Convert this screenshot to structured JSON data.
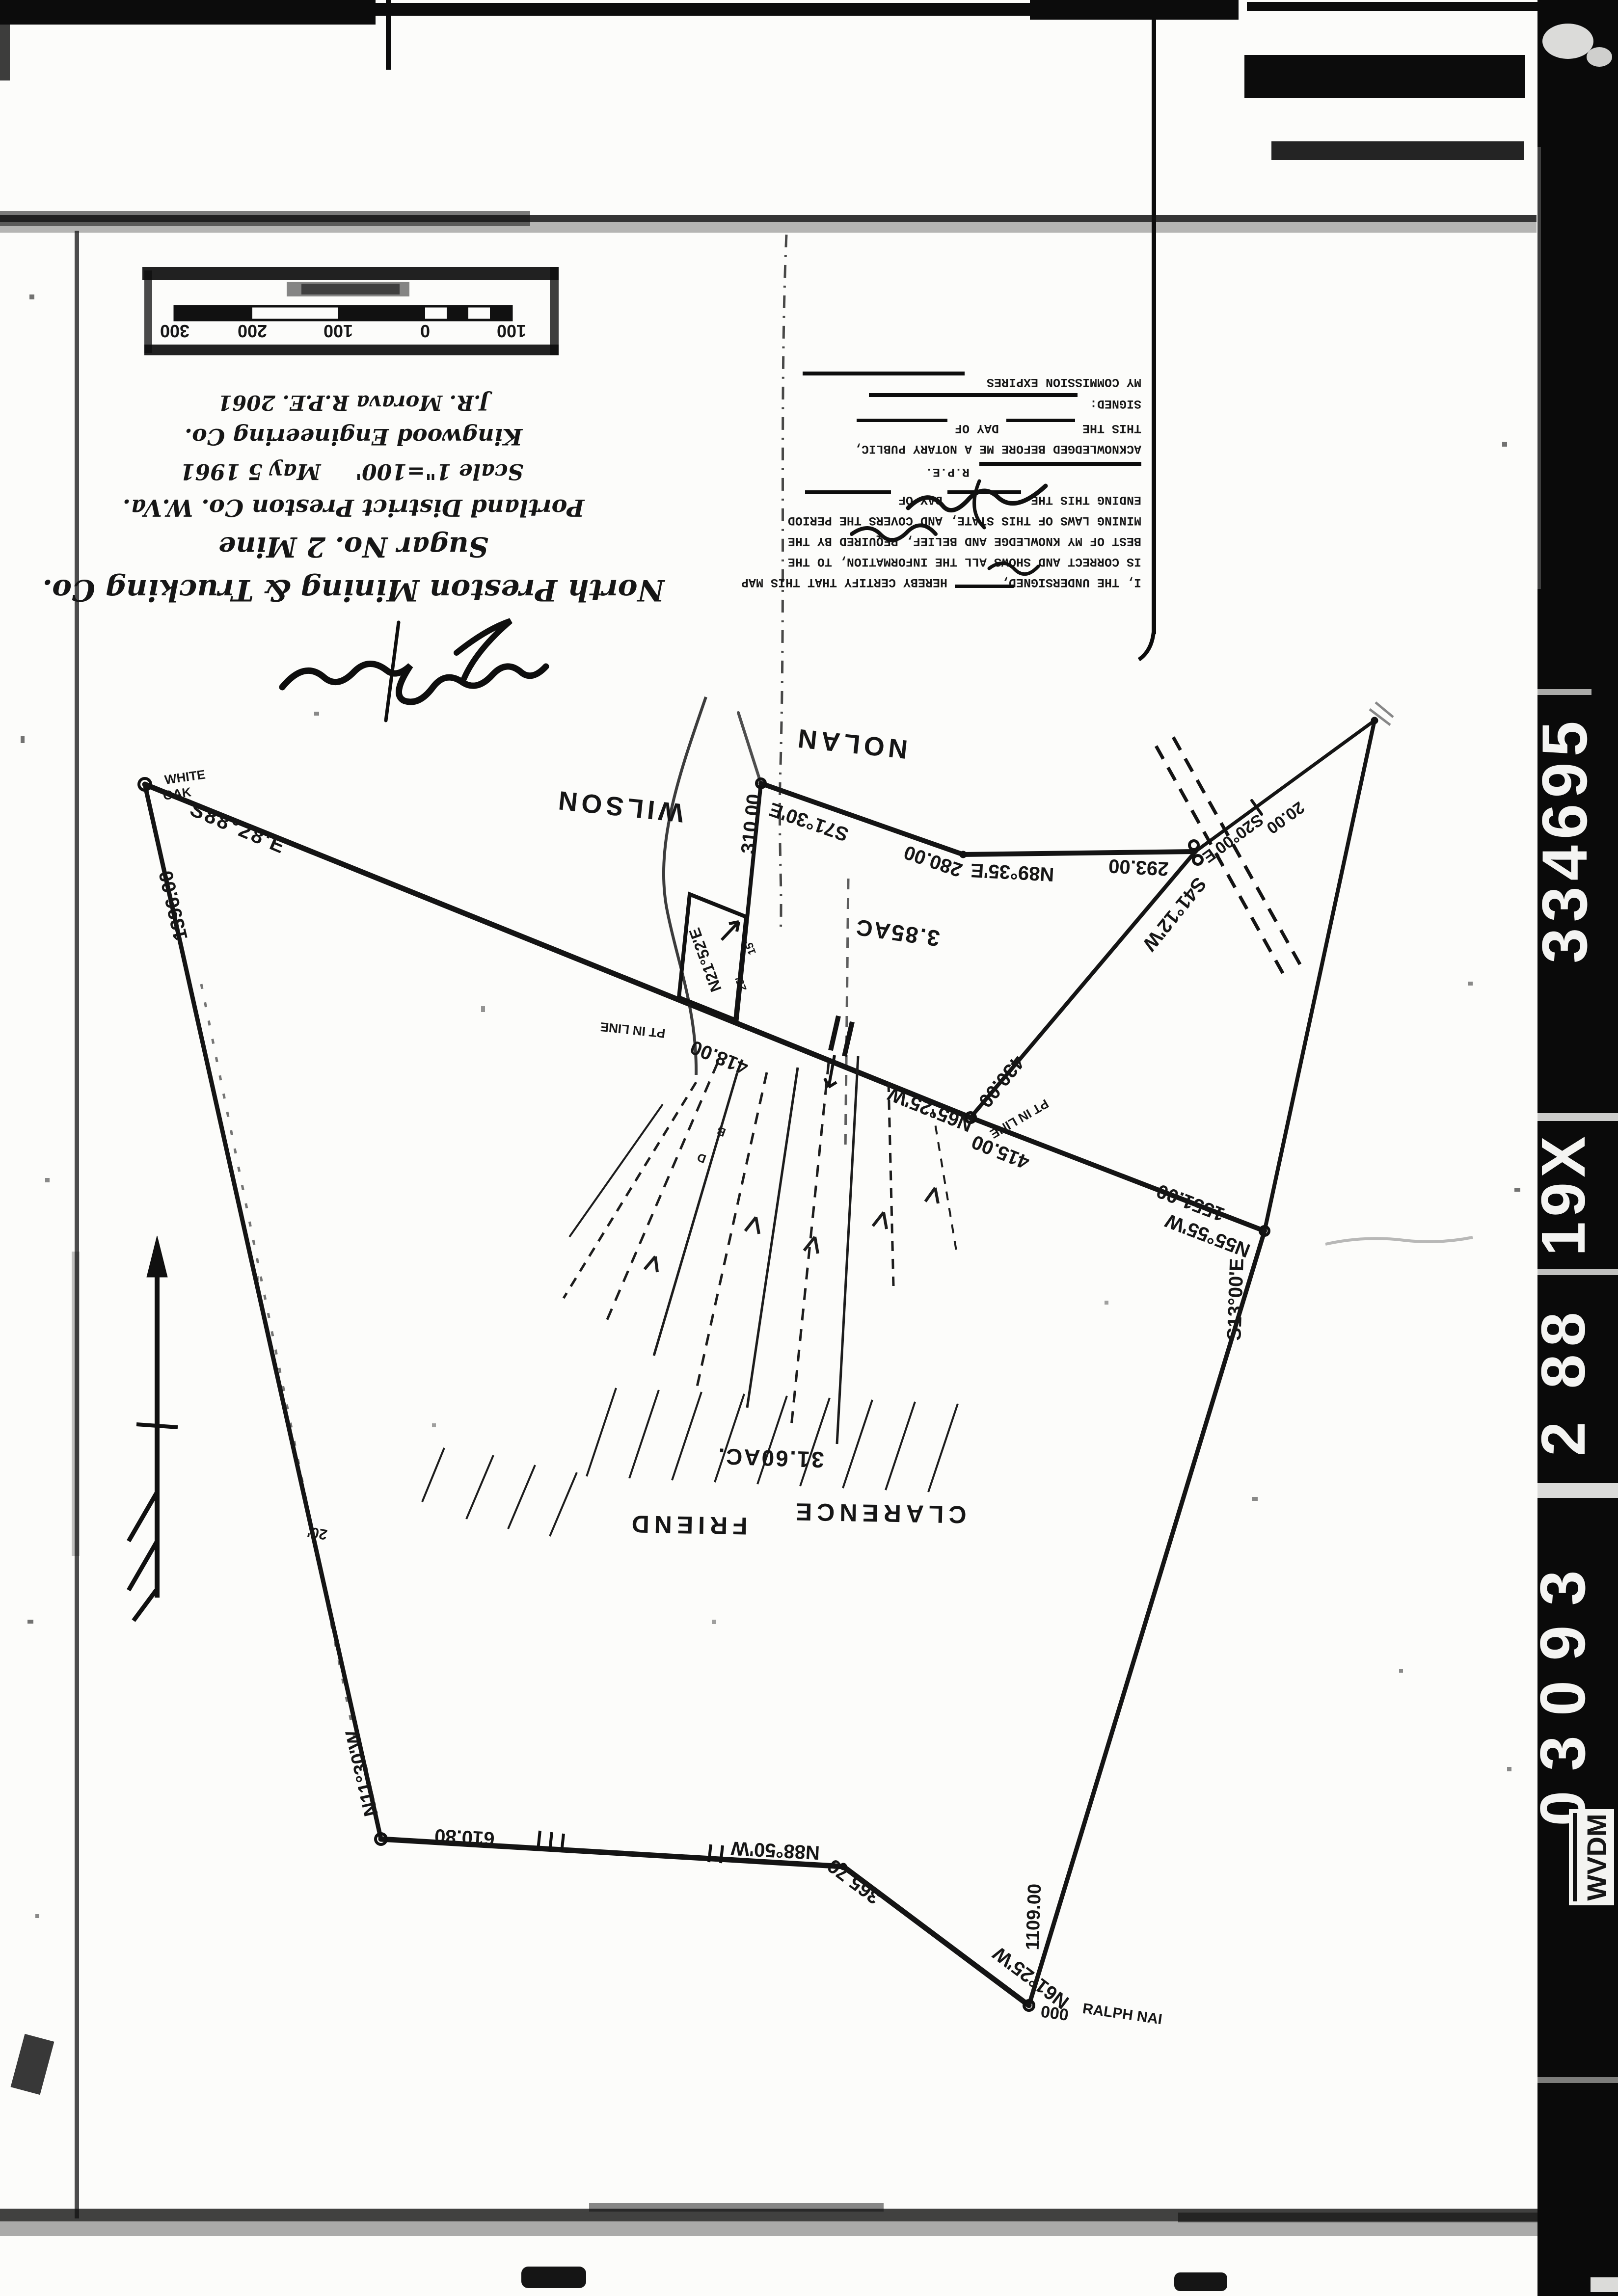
{
  "film_strip": {
    "agency": "WVDM",
    "id_bottom": "03093",
    "id_mid": "2 88",
    "id_upper": "19X",
    "id_top": "334695"
  },
  "title_block": {
    "company": "North Preston Mining & Trucking Co.",
    "mine": "Sugar No. 2 Mine",
    "district": "Portland District Preston Co. W.Va.",
    "scale": "Scale 1\"=100'",
    "date": "May 5 1961",
    "engineer": "Kingwood Engineering Co.",
    "registration": "J.R. Morava R.P.E. 2061"
  },
  "certification": {
    "line1a": "I, THE UNDERSIGNED,",
    "line1b": "HEREBY CERTIFY THAT THIS MAP",
    "line2": "IS CORRECT AND SHOWS ALL THE INFORMATION, TO THE",
    "line3": "BEST OF MY KNOWLEDGE AND BELIEF, REQUIRED BY THE",
    "line4": "MINING LAWS OF THIS STATE, AND COVERS THE PERIOD",
    "line5a": "ENDING THIS THE",
    "line5b": "DAY OF",
    "rpe_label": "R.P.E.",
    "ack1": "ACKNOWLEDGED BEFORE ME A NOTARY PUBLIC,",
    "ack2a": "THIS THE",
    "ack2b": "DAY OF",
    "signed_label": "SIGNED:",
    "commission_label": "MY COMMISSION EXPIRES"
  },
  "scale_bar": {
    "tick_labels": [
      "100",
      "0",
      "100",
      "200",
      "300"
    ]
  },
  "map": {
    "owners": {
      "north1": "NOLAN",
      "north2": "WILSON",
      "central1": "CLARENCE",
      "central2": "FRIEND",
      "south_corner": "RALPH NAI"
    },
    "parcels": {
      "small": "3.85AC",
      "large": "31.60AC."
    },
    "corner_tree": {
      "l1": "WHITE",
      "l2": "OAK"
    },
    "point_labels": {
      "pt_in_line_a": "PT IN LINE",
      "pt_in_line_b": "PT IN LINE",
      "triple_o": "000",
      "letter_b": "B",
      "letter_d": "D",
      "tick_15": "15'",
      "tick_25": "25'",
      "offset_20": "20'"
    },
    "bearings": {
      "b_s8828": "S88°28'E",
      "d_1396": "1396.00",
      "b_n1130": "N11°30'W",
      "d_610": "610.80",
      "b_n8850": "N88°50'W",
      "d_365": "365.76",
      "b_n6125": "N61°25'W",
      "d_1109": "1109.00",
      "b_s1300": "S13°00'E",
      "b_n5555": "N55°55'W",
      "d_1551": "1551.00",
      "d_415": "415.00",
      "b_n6525": "N65°25'W",
      "d_418": "418.00",
      "d_430": "430.00",
      "d_310": "310.00",
      "b_s7130": "S71°30'E",
      "d_280": "280.00",
      "b_n8935": "N89°35'E",
      "d_293": "293.00",
      "b_s2000": "S20°00'E",
      "d_20": "20.00",
      "b_s4112": "S41°12'W",
      "b_n2152": "N21°52'E"
    }
  }
}
